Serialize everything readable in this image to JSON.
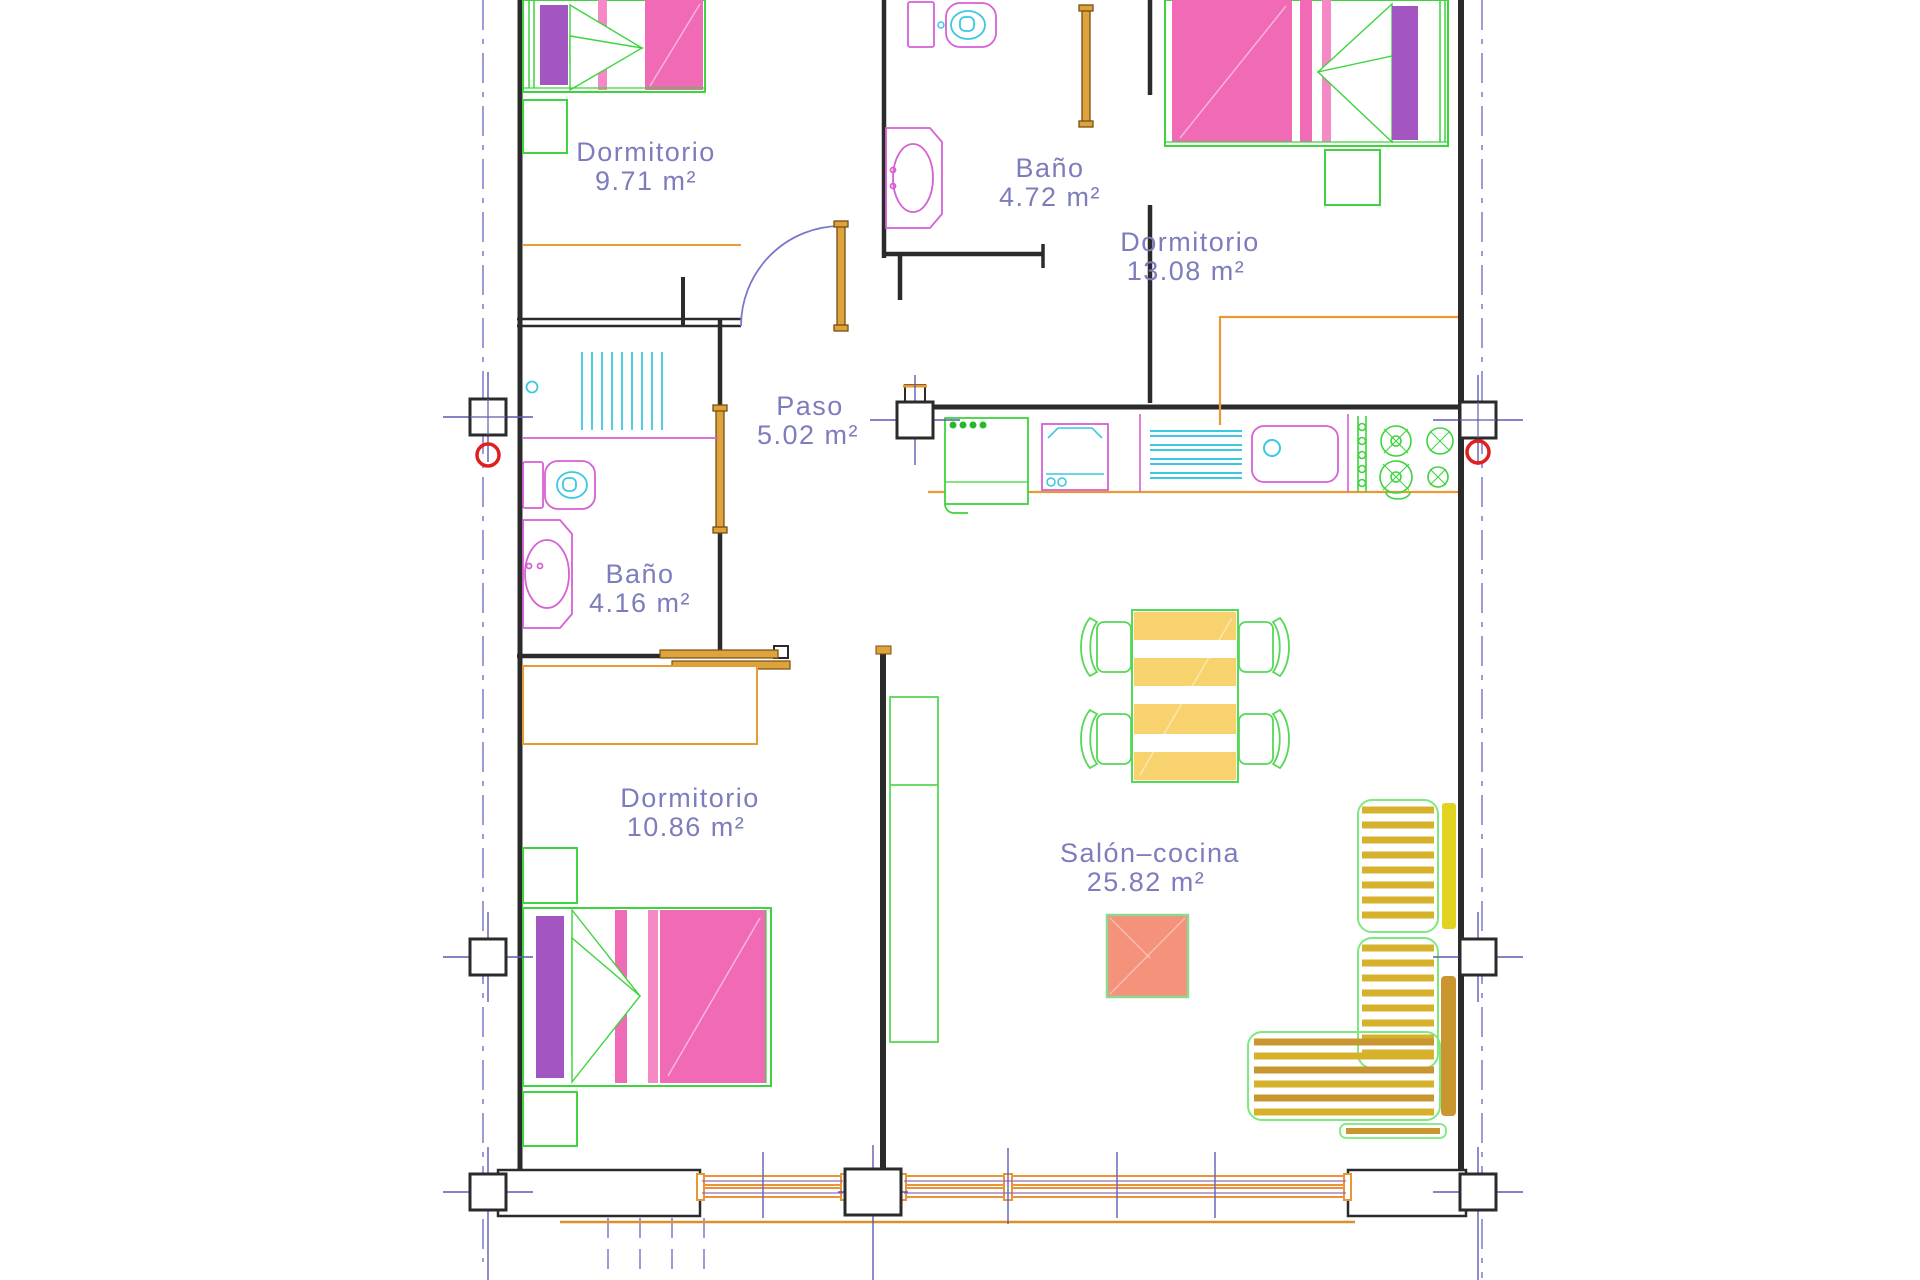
{
  "document": {
    "type": "architectural-floor-plan",
    "language": "es",
    "view": "planta-amueblada"
  },
  "rooms": [
    {
      "id": "dormitorio-1",
      "name": "Dormitorio",
      "area": "9.71 m²"
    },
    {
      "id": "bano-1",
      "name": "Baño",
      "area": "4.72 m²"
    },
    {
      "id": "dormitorio-2",
      "name": "Dormitorio",
      "area": "13.08 m²"
    },
    {
      "id": "paso",
      "name": "Paso",
      "area": "5.02 m²"
    },
    {
      "id": "bano-2",
      "name": "Baño",
      "area": "4.16 m²"
    },
    {
      "id": "dormitorio-3",
      "name": "Dormitorio",
      "area": "10.86 m²"
    },
    {
      "id": "salon-cocina",
      "name": "Salón–cocina",
      "area": "25.82 m²"
    }
  ],
  "fixtures": [
    "double-bed-icon",
    "single-bed-icon",
    "nightstand-icon",
    "wardrobe-icon",
    "toilet-icon",
    "washbasin-icon",
    "shower-grille-icon",
    "fridge-icon",
    "oven-icon",
    "drainboard-icon",
    "sink-icon",
    "hob-4-burners-icon",
    "dining-table-icon",
    "chair-icon",
    "coffee-table-icon",
    "l-shaped-sofa-icon",
    "tv-cabinet-icon",
    "structural-column-icon",
    "window-icon",
    "door-leaf-icon",
    "door-swing-arc-icon"
  ],
  "colors": {
    "wall": "#2b2b2b",
    "centerline_blue": "#8484cf",
    "label_text": "#7d7dbd",
    "column_marker_red": "#e02020",
    "carpentry_orange": "#e89a35",
    "bed_pink": "#f06ab5",
    "pillow_purple": "#a356c2",
    "fixture_magenta": "#d561d5",
    "fixture_cyan": "#3cc8e0",
    "furniture_green": "#3dd43d",
    "table_yellow": "#f8d36d",
    "sofa_gold": "#d6b22c",
    "sofa_tan": "#c9962f",
    "coffee_table_coral": "#f4927c"
  }
}
